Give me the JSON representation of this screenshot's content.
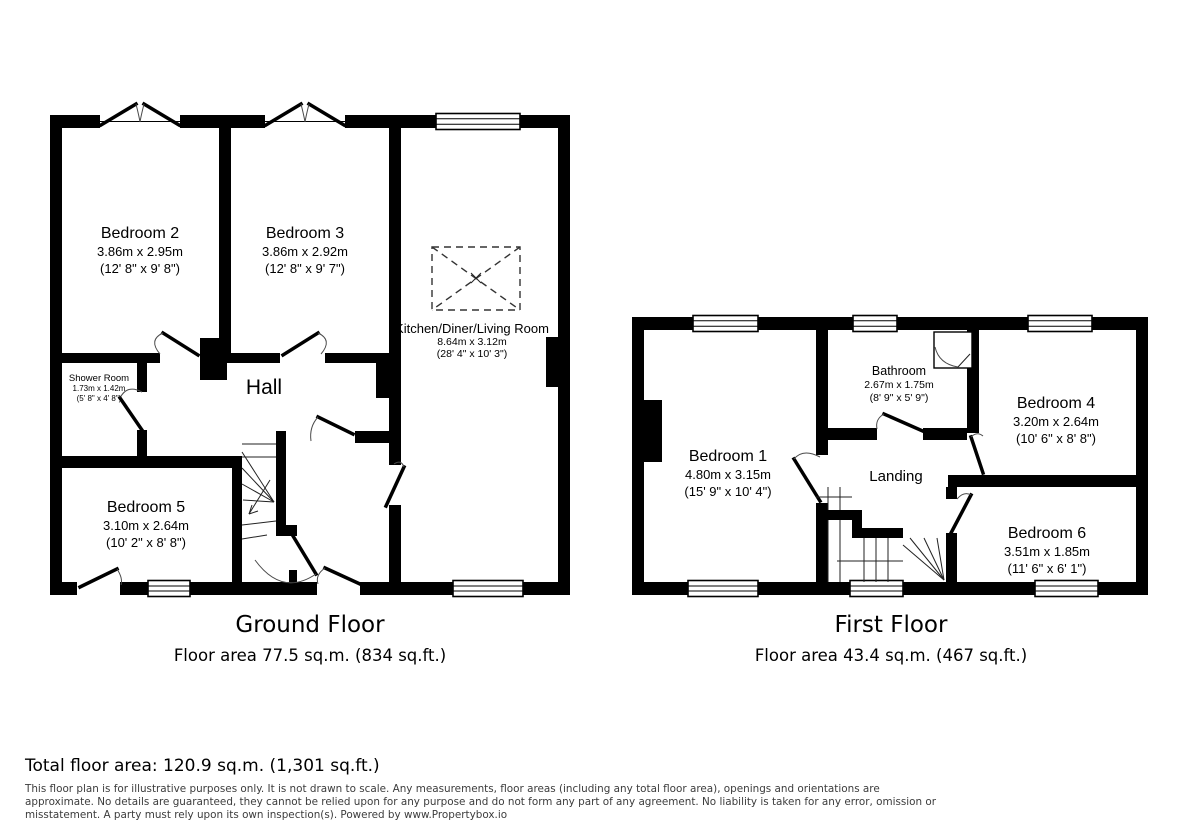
{
  "ground_floor": {
    "title": "Ground Floor",
    "area": "Floor area 77.5 sq.m. (834 sq.ft.)",
    "rooms": {
      "bedroom2": {
        "name": "Bedroom 2",
        "metric": "3.86m x 2.95m",
        "imperial": "(12' 8\" x 9' 8\")"
      },
      "bedroom3": {
        "name": "Bedroom 3",
        "metric": "3.86m x 2.92m",
        "imperial": "(12' 8\" x 9' 7\")"
      },
      "kitchen": {
        "name": "Kitchen/Diner/Living Room",
        "metric": "8.64m x 3.12m",
        "imperial": "(28' 4\" x 10' 3\")"
      },
      "shower": {
        "name": "Shower Room",
        "metric": "1.73m x 1.42m",
        "imperial": "(5' 8\" x 4' 8\")"
      },
      "hall": {
        "name": "Hall"
      },
      "bedroom5": {
        "name": "Bedroom 5",
        "metric": "3.10m x 2.64m",
        "imperial": "(10' 2\" x 8' 8\")"
      }
    }
  },
  "first_floor": {
    "title": "First Floor",
    "area": "Floor area 43.4 sq.m. (467 sq.ft.)",
    "rooms": {
      "bedroom1": {
        "name": "Bedroom 1",
        "metric": "4.80m x 3.15m",
        "imperial": "(15' 9\" x 10' 4\")"
      },
      "bathroom": {
        "name": "Bathroom",
        "metric": "2.67m x 1.75m",
        "imperial": "(8' 9\" x 5' 9\")"
      },
      "bedroom4": {
        "name": "Bedroom 4",
        "metric": "3.20m x 2.64m",
        "imperial": "(10' 6\" x 8' 8\")"
      },
      "landing": {
        "name": "Landing"
      },
      "bedroom6": {
        "name": "Bedroom 6",
        "metric": "3.51m x 1.85m",
        "imperial": "(11' 6\" x 6' 1\")"
      }
    }
  },
  "summary": {
    "total": "Total floor area: 120.9 sq.m. (1,301 sq.ft.)"
  },
  "disclaimer": {
    "line1": "This floor plan is for illustrative purposes only. It is not drawn to scale. Any measurements, floor areas (including any total floor area), openings and orientations are",
    "line2": "approximate. No details are guaranteed, they cannot be relied upon for any purpose and do not form any part of any agreement. No liability is taken for any error, omission or",
    "line3": "misstatement. A party must rely upon its own inspection(s). Powered by www.Propertybox.io"
  },
  "colors": {
    "wall": "#000000",
    "text": "#000000",
    "muted_text": "#3c3c3c",
    "background": "#ffffff"
  }
}
